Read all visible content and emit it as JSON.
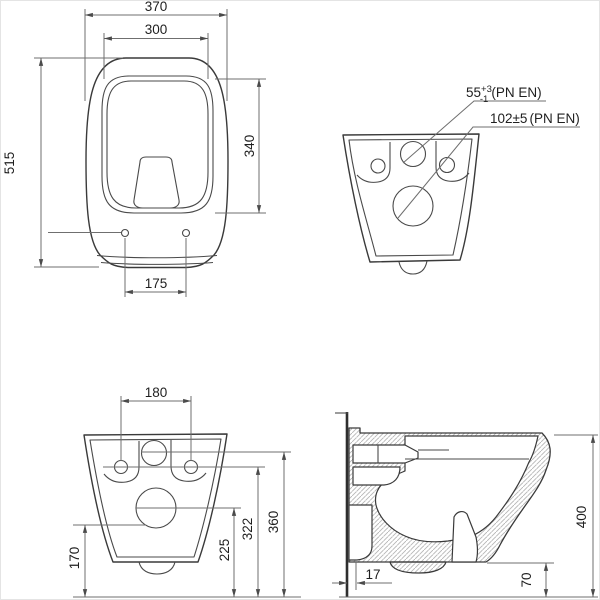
{
  "title": "Wall-hung WC technical drawing",
  "colors": {
    "line": "#3a3a3a",
    "dim_line": "#6f6f6f",
    "text": "#1f1f1f",
    "hatch": "#b5b5b5",
    "background": "#ffffff",
    "border": "#e4e4e4"
  },
  "views": {
    "front": {
      "label": "front view (lid closed)",
      "dims": {
        "overall_width": "370",
        "seat_width": "300",
        "overall_height": "515",
        "seat_height": "340",
        "hinge_hole_spacing": "175"
      }
    },
    "rear": {
      "label": "rear connection view",
      "callouts": {
        "inlet_value": "55",
        "inlet_tolerance_plus": "+3",
        "inlet_tolerance_minus": "-1",
        "inlet_standard": "(PN EN)",
        "outlet_value": "102±5",
        "outlet_standard": "(PN EN)"
      }
    },
    "rear_dimensioned": {
      "label": "rear view with heights",
      "dims": {
        "fixing_hole_spacing": "180",
        "bottom_edge_height": "170",
        "outlet_center_height": "225",
        "fixing_holes_height": "322",
        "inlet_center_height": "360"
      }
    },
    "side": {
      "label": "side section",
      "dims": {
        "wall_gap": "17",
        "underside_clearance": "70",
        "overall_height": "400"
      }
    }
  }
}
